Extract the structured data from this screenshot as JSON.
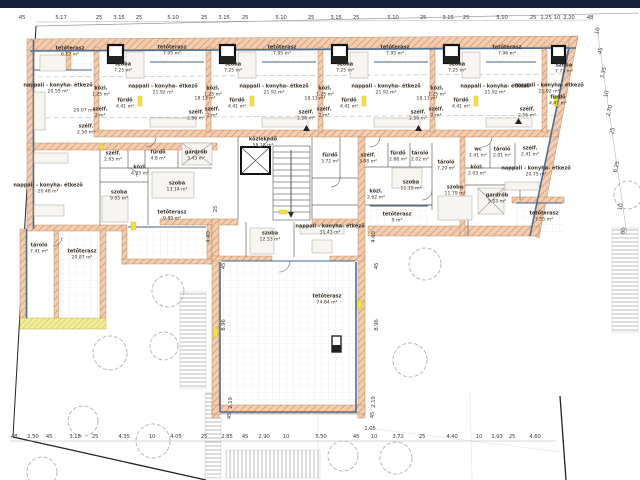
{
  "meta": {
    "drawing_type": "architectural floor plan",
    "language": "hu"
  },
  "colors": {
    "top_bar": "#15203a",
    "wall_fill": "#f3cdb0",
    "wall_hatch": "#cc8a5e",
    "insulation": "#4a6e96",
    "window_highlight": "#f2e23a",
    "label_text": "#3b3229",
    "dim_text": "#44403a"
  },
  "rooms": [
    {
      "label": "tetőterasz",
      "area": "6.12 m²",
      "x": 70,
      "y": 52
    },
    {
      "label": "nappali - konyha- étkező",
      "area": "20.55 m²",
      "x": 58,
      "y": 89
    },
    {
      "area": "20.07 m²",
      "x": 84,
      "y": 111
    },
    {
      "label": "szélf.",
      "area": "2.56 m²",
      "x": 86,
      "y": 130
    },
    {
      "label": "szoba",
      "area": "7.25 m²",
      "x": 123,
      "y": 68
    },
    {
      "label": "tetőterasz",
      "area": "7.95 m²",
      "x": 172,
      "y": 51
    },
    {
      "label": "nappali - konyha- étkező",
      "area": "21.92 m²",
      "x": 163,
      "y": 90
    },
    {
      "area": "18.13 m²",
      "x": 205,
      "y": 99
    },
    {
      "label": "közl.",
      "area": "1.25 m²",
      "x": 101,
      "y": 92
    },
    {
      "label": "fürdő",
      "area": "4.41 m²",
      "x": 125,
      "y": 104
    },
    {
      "label": "szélf.",
      "area": "2 m²",
      "x": 100,
      "y": 113
    },
    {
      "label": "szélf.",
      "area": "2.56 m²",
      "x": 196,
      "y": 116
    },
    {
      "label": "szoba",
      "area": "7.25 m²",
      "x": 233,
      "y": 68
    },
    {
      "label": "tetőterasz",
      "area": "7.95 m²",
      "x": 282,
      "y": 51
    },
    {
      "label": "nappali - konyha- étkező",
      "area": "21.92 m²",
      "x": 274,
      "y": 90
    },
    {
      "area": "18.13 m²",
      "x": 315,
      "y": 99
    },
    {
      "label": "közl.",
      "area": "1.25 m²",
      "x": 213,
      "y": 92
    },
    {
      "label": "fürdő",
      "area": "4.41 m²",
      "x": 237,
      "y": 104
    },
    {
      "label": "szélf.",
      "area": "2 m²",
      "x": 212,
      "y": 113
    },
    {
      "label": "szélf.",
      "area": "2.56 m²",
      "x": 306,
      "y": 116
    },
    {
      "label": "szoba",
      "area": "7.25 m²",
      "x": 345,
      "y": 68
    },
    {
      "label": "tetőterasz",
      "area": "7.95 m²",
      "x": 395,
      "y": 51
    },
    {
      "label": "nappali - konyha- étkező",
      "area": "21.92 m²",
      "x": 386,
      "y": 90
    },
    {
      "area": "18.13 m²",
      "x": 427,
      "y": 99
    },
    {
      "label": "közl.",
      "area": "1.25 m²",
      "x": 325,
      "y": 92
    },
    {
      "label": "fürdő",
      "area": "4.41 m²",
      "x": 349,
      "y": 104
    },
    {
      "label": "szélf.",
      "area": "2 m²",
      "x": 324,
      "y": 113
    },
    {
      "label": "szélf.",
      "area": "2.56 m²",
      "x": 418,
      "y": 116
    },
    {
      "label": "szoba",
      "area": "7.25 m²",
      "x": 457,
      "y": 68
    },
    {
      "label": "tetőterasz",
      "area": "7.96 m²",
      "x": 507,
      "y": 51
    },
    {
      "label": "nappali - konyha- étkező",
      "area": "21.92 m²",
      "x": 495,
      "y": 90
    },
    {
      "label": "közl.",
      "area": "1.25 m²",
      "x": 437,
      "y": 92
    },
    {
      "label": "fürdő",
      "area": "4.41 m²",
      "x": 461,
      "y": 104
    },
    {
      "label": "szélf.",
      "area": "2 m²",
      "x": 436,
      "y": 113
    },
    {
      "label": "szélf.",
      "area": "2.56 m²",
      "x": 527,
      "y": 113
    },
    {
      "label": "szoba",
      "area": "7.73 m²",
      "x": 564,
      "y": 69
    },
    {
      "label": "fürdő",
      "area": "4.41 m²",
      "x": 558,
      "y": 101
    },
    {
      "label": "nappali - konyha- étkező",
      "area": "21.92 m²",
      "x": 549,
      "y": 89
    },
    {
      "label": "közlekedő",
      "area": "58.18 m²",
      "x": 263,
      "y": 143
    },
    {
      "label": "szélf.",
      "area": "2.65 m²",
      "x": 113,
      "y": 157
    },
    {
      "label": "fürdő",
      "area": "4.8 m²",
      "x": 158,
      "y": 156
    },
    {
      "label": "gardrób",
      "area": "3.43 m²",
      "x": 196,
      "y": 156
    },
    {
      "label": "közl.",
      "area": "4.35 m²",
      "x": 140,
      "y": 171
    },
    {
      "label": "szoba",
      "area": "9.65 m²",
      "x": 119,
      "y": 196
    },
    {
      "label": "szoba",
      "area": "13.14 m²",
      "x": 177,
      "y": 187
    },
    {
      "label": "nappali - konyha- étkező",
      "area": "20.46 m²",
      "x": 48,
      "y": 189
    },
    {
      "label": "tetőterasz",
      "area": "9.89 m²",
      "x": 172,
      "y": 216
    },
    {
      "label": "tároló",
      "area": "7.41 m²",
      "x": 39,
      "y": 249
    },
    {
      "label": "tetőterasz",
      "area": "20.87 m²",
      "x": 82,
      "y": 255
    },
    {
      "label": "szoba",
      "area": "12.53 m²",
      "x": 270,
      "y": 237
    },
    {
      "label": "nappali - konyha- étkező",
      "area": "31.43 m²",
      "x": 330,
      "y": 230
    },
    {
      "label": "fürdő",
      "area": "3.72 m²",
      "x": 330,
      "y": 159
    },
    {
      "label": "szélf.",
      "area": "3.08 m²",
      "x": 368,
      "y": 159
    },
    {
      "label": "közl.",
      "area": "2.62 m²",
      "x": 376,
      "y": 195
    },
    {
      "label": "tetőterasz",
      "area": "74.84 m²",
      "x": 327,
      "y": 300
    },
    {
      "label": "fürdő",
      "area": "2.88 m²",
      "x": 398,
      "y": 157
    },
    {
      "label": "tároló",
      "area": "2.02 m²",
      "x": 420,
      "y": 157
    },
    {
      "label": "tároló",
      "area": "7.29 m²",
      "x": 446,
      "y": 166
    },
    {
      "label": "szoba",
      "area": "11.15 m²",
      "x": 411,
      "y": 186
    },
    {
      "label": "szoba",
      "area": "11.79 m²",
      "x": 455,
      "y": 191
    },
    {
      "label": "tetőterasz",
      "area": "9 m²",
      "x": 397,
      "y": 218
    },
    {
      "label": "wc",
      "area": "1.41 m²",
      "x": 478,
      "y": 153
    },
    {
      "label": "tároló",
      "area": "2.01 m²",
      "x": 502,
      "y": 153
    },
    {
      "label": "közl.",
      "area": "2.03 m²",
      "x": 477,
      "y": 171
    },
    {
      "label": "gardrób",
      "area": "5.03 m²",
      "x": 497,
      "y": 199
    },
    {
      "label": "szélf.",
      "area": "2.41 m²",
      "x": 530,
      "y": 152
    },
    {
      "label": "nappali - konyha- étkező",
      "area": "20.75 m²",
      "x": 536,
      "y": 172
    },
    {
      "label": "tetőterasz",
      "area": "7.55 m²",
      "x": 544,
      "y": 217
    }
  ],
  "dims_top": {
    "y": 18,
    "items": [
      {
        "t": "45",
        "x": 22
      },
      {
        "t": "5.17",
        "x": 61
      },
      {
        "t": "25",
        "x": 99
      },
      {
        "t": "3.15",
        "x": 119
      },
      {
        "t": "25",
        "x": 139
      },
      {
        "t": "5.10",
        "x": 173
      },
      {
        "t": "25",
        "x": 204
      },
      {
        "t": "3.15",
        "x": 224
      },
      {
        "t": "25",
        "x": 245
      },
      {
        "t": "5.10",
        "x": 281
      },
      {
        "t": "25",
        "x": 311
      },
      {
        "t": "3.15",
        "x": 336
      },
      {
        "t": "25",
        "x": 356
      },
      {
        "t": "5.10",
        "x": 393
      },
      {
        "t": "25",
        "x": 423
      },
      {
        "t": "3.15",
        "x": 448
      },
      {
        "t": "25",
        "x": 466
      },
      {
        "t": "5.10",
        "x": 502
      },
      {
        "t": "25",
        "x": 533
      },
      {
        "t": "1.25",
        "x": 546
      },
      {
        "t": "10",
        "x": 557
      },
      {
        "t": "2.20",
        "x": 569
      },
      {
        "t": "48",
        "x": 590
      }
    ]
  },
  "dims_bottom": {
    "y": 437,
    "items": [
      {
        "t": "48",
        "x": 14
      },
      {
        "t": "2.50",
        "x": 33
      },
      {
        "t": "45",
        "x": 49
      },
      {
        "t": "3.18",
        "x": 75
      },
      {
        "t": "25",
        "x": 95
      },
      {
        "t": "4.35",
        "x": 124
      },
      {
        "t": "10",
        "x": 152
      },
      {
        "t": "4.05",
        "x": 176
      },
      {
        "t": "25",
        "x": 204
      },
      {
        "t": "2.85",
        "x": 227
      },
      {
        "t": "45",
        "x": 245
      },
      {
        "t": "2.90",
        "x": 264
      },
      {
        "t": "10",
        "x": 286
      },
      {
        "t": "5.50",
        "x": 321
      },
      {
        "t": "45",
        "x": 356
      },
      {
        "t": "10",
        "x": 374
      },
      {
        "t": "3.72",
        "x": 398
      },
      {
        "t": "25",
        "x": 422
      },
      {
        "t": "4.40",
        "x": 452
      },
      {
        "t": "10",
        "x": 479
      },
      {
        "t": "1.93",
        "x": 497
      },
      {
        "t": "25",
        "x": 512
      },
      {
        "t": "4.60",
        "x": 535
      }
    ]
  },
  "dims_right": {
    "rot": -78,
    "items": [
      {
        "t": "10",
        "x": 598,
        "y": 31
      },
      {
        "t": "45",
        "x": 601,
        "y": 51
      },
      {
        "t": "3.35",
        "x": 604,
        "y": 73
      },
      {
        "t": "10",
        "x": 607,
        "y": 94
      },
      {
        "t": "2.70",
        "x": 610,
        "y": 111
      },
      {
        "t": "25",
        "x": 613,
        "y": 131
      },
      {
        "t": "6.25",
        "x": 617,
        "y": 167
      },
      {
        "t": "10",
        "x": 621,
        "y": 207
      },
      {
        "t": "80",
        "x": 624,
        "y": 231
      }
    ]
  },
  "dims_misc": {
    "rot": -90,
    "items": [
      {
        "t": "25",
        "x": 216,
        "y": 209
      },
      {
        "t": "4.40",
        "x": 209,
        "y": 237
      },
      {
        "t": "45",
        "x": 224,
        "y": 266
      },
      {
        "t": "8.96",
        "x": 224,
        "y": 325
      },
      {
        "t": "4.60",
        "x": 374,
        "y": 237
      },
      {
        "t": "45",
        "x": 377,
        "y": 266
      },
      {
        "t": "8.96",
        "x": 377,
        "y": 325
      },
      {
        "t": "2.19",
        "x": 231,
        "y": 403
      },
      {
        "t": "45",
        "x": 230,
        "y": 416
      },
      {
        "t": "2.19",
        "x": 374,
        "y": 402
      },
      {
        "t": "45",
        "x": 373,
        "y": 415
      },
      {
        "t": "1.05",
        "x": 370,
        "y": 429,
        "rot": 0
      }
    ]
  }
}
